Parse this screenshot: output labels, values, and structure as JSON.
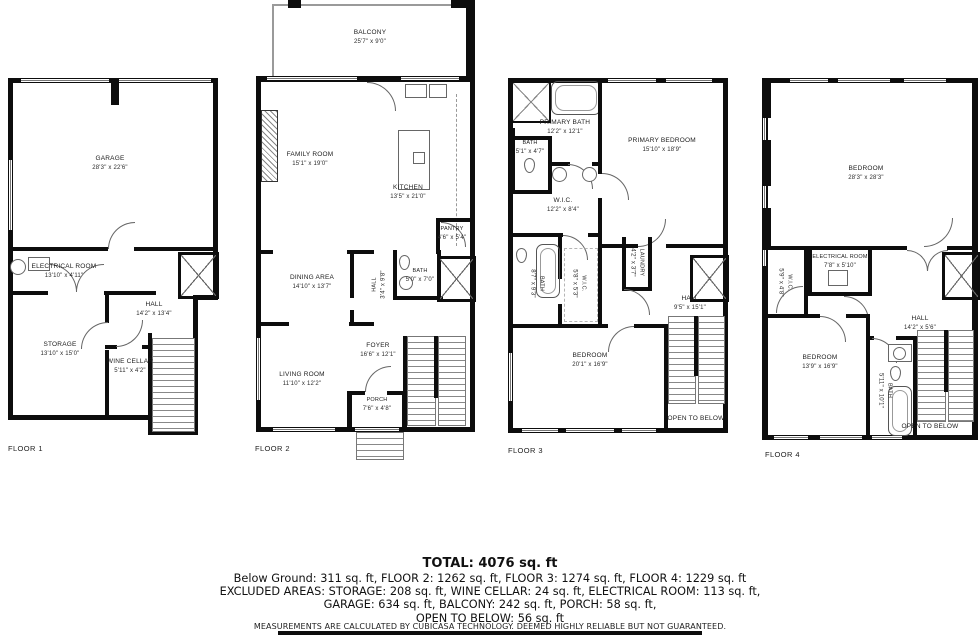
{
  "wall_color": "#0d0d0d",
  "floor1": {
    "label": "FLOOR 1",
    "garage": {
      "name": "GARAGE",
      "dims": "28'3\" x 22'6\""
    },
    "electrical": {
      "name": "ELECTRICAL ROOM",
      "dims": "13'10\" x 4'11\""
    },
    "hall": {
      "name": "HALL",
      "dims": "14'2\" x 13'4\""
    },
    "storage": {
      "name": "STORAGE",
      "dims": "13'10\" x 15'0\""
    },
    "wine_cellar": {
      "name": "WINE CELLAR",
      "dims": "5'11\" x 4'2\""
    }
  },
  "floor2": {
    "label": "FLOOR 2",
    "balcony": {
      "name": "BALCONY",
      "dims": "25'7\" x 9'0\""
    },
    "family_room": {
      "name": "FAMILY ROOM",
      "dims": "15'1\" x 19'0\""
    },
    "kitchen": {
      "name": "KITCHEN",
      "dims": "13'5\" x 21'0\""
    },
    "pantry": {
      "name": "PANTRY",
      "dims": "4'6\" x 5'4\""
    },
    "dining_area": {
      "name": "DINING AREA",
      "dims": "14'10\" x 13'7\""
    },
    "hall": {
      "name": "HALL",
      "dims": "3'4\" x 9'8\""
    },
    "bath": {
      "name": "BATH",
      "dims": "5'0\" x 7'0\""
    },
    "foyer": {
      "name": "FOYER",
      "dims": "16'6\" x 12'1\""
    },
    "living_room": {
      "name": "LIVING ROOM",
      "dims": "11'10\" x 12'2\""
    },
    "porch": {
      "name": "PORCH",
      "dims": "7'6\" x 4'8\""
    }
  },
  "floor3": {
    "label": "FLOOR 3",
    "primary_bath": {
      "name": "PRIMARY BATH",
      "dims": "12'2\" x 12'1\""
    },
    "bath_small": {
      "name": "BATH",
      "dims": "5'1\" x 4'7\""
    },
    "primary_bedroom": {
      "name": "PRIMARY BEDROOM",
      "dims": "15'10\" x 18'9\""
    },
    "wic_upper": {
      "name": "W.I.C.",
      "dims": "12'2\" x 8'4\""
    },
    "bath_lower": {
      "name": "BATH",
      "dims": "8'7\" x 9'3\""
    },
    "wic_lower": {
      "name": "W.I.C.",
      "dims": "5'8\" x 5'3\""
    },
    "laundry": {
      "name": "LAUNDRY",
      "dims": "4'2\" x 3'7\""
    },
    "hall": {
      "name": "HALL",
      "dims": "9'5\" x 15'1\""
    },
    "bedroom": {
      "name": "BEDROOM",
      "dims": "20'1\" x 16'9\""
    },
    "open_to_below": "OPEN TO BELOW"
  },
  "floor4": {
    "label": "FLOOR 4",
    "bedroom_large": {
      "name": "BEDROOM",
      "dims": "28'3\" x 28'3\""
    },
    "electrical": {
      "name": "ELECTRICAL ROOM",
      "dims": "7'8\" x 5'10\""
    },
    "wic": {
      "name": "W.I.C.",
      "dims": "5'9\" x 4'8\""
    },
    "hall": {
      "name": "HALL",
      "dims": "14'2\" x 5'6\""
    },
    "bedroom_small": {
      "name": "BEDROOM",
      "dims": "13'9\" x 16'9\""
    },
    "bath": {
      "name": "BATH",
      "dims": "5'11\" x 10'1\""
    },
    "open_to_below": "OPEN TO BELOW"
  },
  "summary": {
    "total": "TOTAL: 4076 sq. ft",
    "line1": "Below Ground: 311 sq. ft, FLOOR 2: 1262 sq. ft, FLOOR 3: 1274 sq. ft, FLOOR 4: 1229 sq. ft",
    "line2": "EXCLUDED AREAS: STORAGE: 208 sq. ft, WINE CELLAR: 24 sq. ft, ELECTRICAL ROOM: 113 sq. ft,",
    "line3": "GARAGE: 634 sq. ft, BALCONY: 242 sq. ft, PORCH: 58 sq. ft,",
    "line4": "OPEN TO BELOW: 56 sq. ft",
    "disclaimer": "MEASUREMENTS ARE CALCULATED BY CUBICASA TECHNOLOGY. DEEMED HIGHLY RELIABLE BUT NOT GUARANTEED."
  }
}
